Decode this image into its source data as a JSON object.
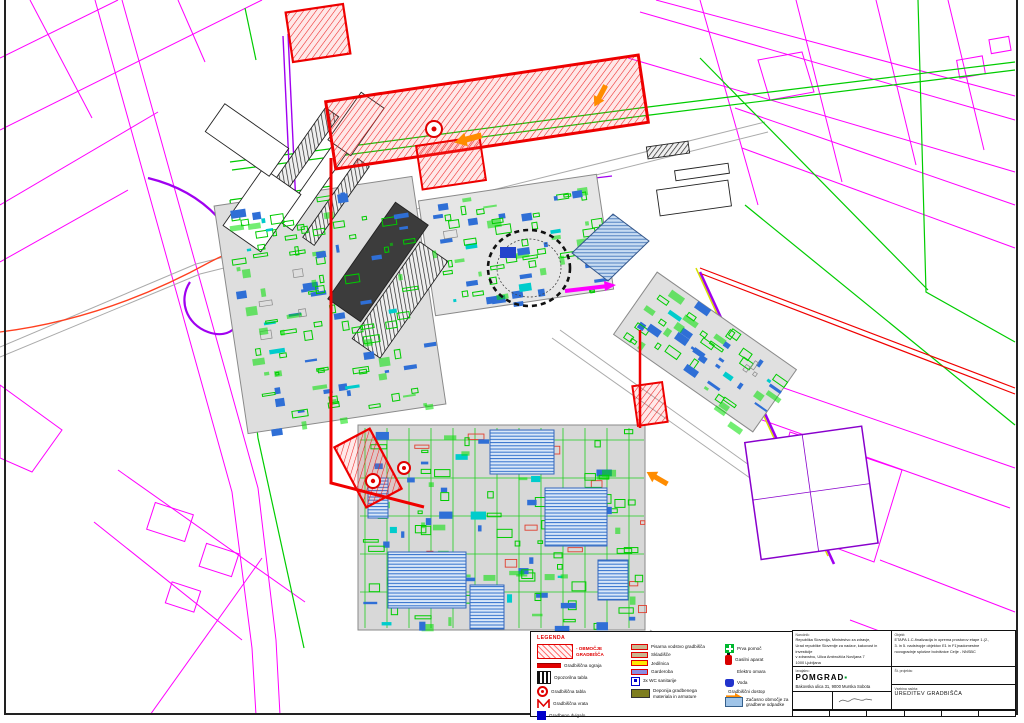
{
  "legend": {
    "title": "LEGENDA",
    "col1": [
      {
        "icon": "construction-zone",
        "label": "- OBMOČJE GRADBIŠČA"
      },
      {
        "icon": "site-fence",
        "label": "Gradbiščna ograja"
      },
      {
        "icon": "warning-sign",
        "label": "Opozorilna tabla"
      },
      {
        "icon": "site-sign",
        "label": "Gradbiščna tabla"
      },
      {
        "icon": "site-gate",
        "label": "Gradbiščna vrata"
      },
      {
        "icon": "construction-hoist",
        "label": "Gradbeno dvigalo"
      }
    ],
    "col2": [
      {
        "icon": "office-cabin",
        "label": "Pisarna vodstvo gradbišča"
      },
      {
        "icon": "storage-cabin",
        "label": "Skladišče"
      },
      {
        "icon": "dining-cabin",
        "label": "Jedilnica"
      },
      {
        "icon": "wardrobe-cabin",
        "label": "Garderoba"
      },
      {
        "icon": "wc-unit",
        "label": "3x WC sanitarije"
      },
      {
        "icon": "material-depot",
        "label": "Deponija gradbenega\nmateriala in armature"
      }
    ],
    "col3": [
      {
        "icon": "first-aid",
        "label": "Prva pomoč"
      },
      {
        "icon": "fire-extinguisher",
        "label": "Gasilni aparat"
      },
      {
        "icon": "electric-cabinet",
        "label": "Elektro omara"
      },
      {
        "icon": "water-point",
        "label": "Voda"
      },
      {
        "icon": "site-access-arrow",
        "label": "Gradbiščni dostop"
      },
      {
        "icon": "temporary-area",
        "label": "Začasno območje za\ngradbene odpadke"
      }
    ]
  },
  "title_block": {
    "narocnik_label": "Naročnik:",
    "narocnik": "Republika Slovenija, Ministrstvo za zdravje,\nUrad republike Slovenije za nadzor, kakovost in investicije\nv zdravstvu, Ulica Ambrožiča Novljana 7\n1000 Ljubljana",
    "objekt_label": "Objekt:",
    "objekt": "ETAPA 1.C-finalizacija in oprema prostorov etape 1.(2.,\n3. in 5. nadstropje objektov E1 in F1)nadomestne\nnovogradnje splošne bolnišnice Celje - NNSBC",
    "izvajalec_label": "Izvajalec:",
    "izvajalec_name": "POMGRAD",
    "izvajalec_address": "Bakovska ulica 31, 9000 Murska Sobota",
    "st_projekta_label": "Št. projekta:",
    "vsebina_label": "Vsebina načrta:",
    "vsebina": "UREDITEV GRADBIŠČA"
  },
  "map": {
    "colors": {
      "cadastral_magenta": "#FF00FF",
      "road_purple": "#A000F0",
      "utility_green": "#00CC00",
      "construction_red": "#EE0000",
      "access_orange": "#FF8C00",
      "equipment_blue": "#2F6FD6",
      "temporary_lightblue": "#C8DCF2",
      "building_gray": "#D8D8D8"
    }
  }
}
